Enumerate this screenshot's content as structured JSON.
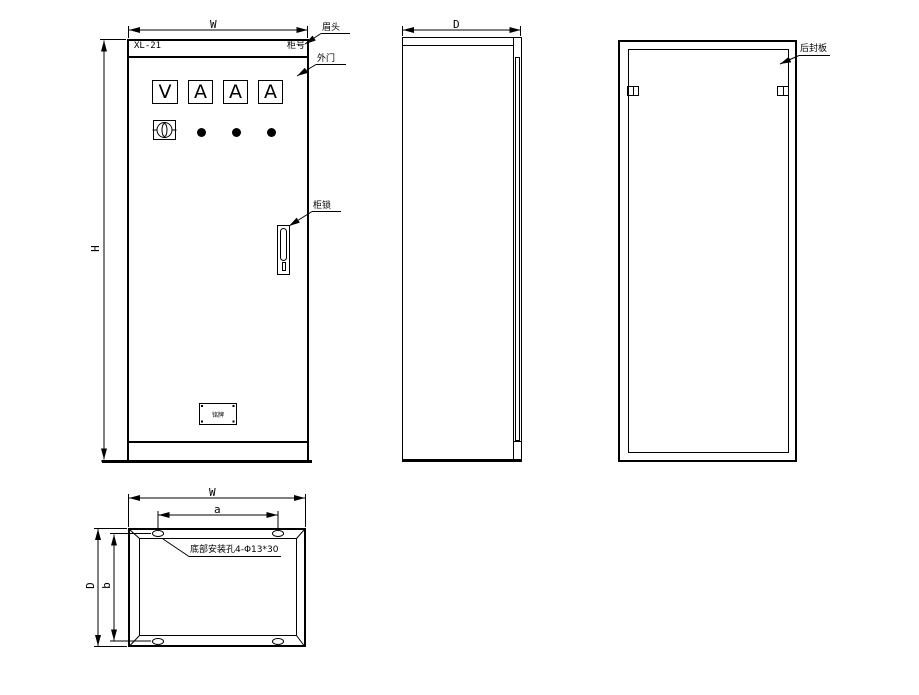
{
  "front_view": {
    "dim_width": "W",
    "dim_height": "H",
    "header": {
      "model": "XL-21",
      "cabinet_no": "柜号"
    },
    "callouts": {
      "header_strip": "眉头",
      "outer_door": "外门",
      "lock": "柜锁"
    },
    "meters": [
      "V",
      "A",
      "A",
      "A"
    ],
    "nameplate": "铭牌"
  },
  "side_view": {
    "dim_depth": "D"
  },
  "back_view": {
    "callout_rear_panel": "后封板"
  },
  "bottom_view": {
    "dim_width": "W",
    "dim_hole_pitch_x": "a",
    "dim_depth": "D",
    "dim_hole_pitch_y": "b",
    "callout_mounting_holes": "底部安装孔4-Φ13*30"
  },
  "colors": {
    "line": "#000000",
    "background": "#ffffff"
  }
}
